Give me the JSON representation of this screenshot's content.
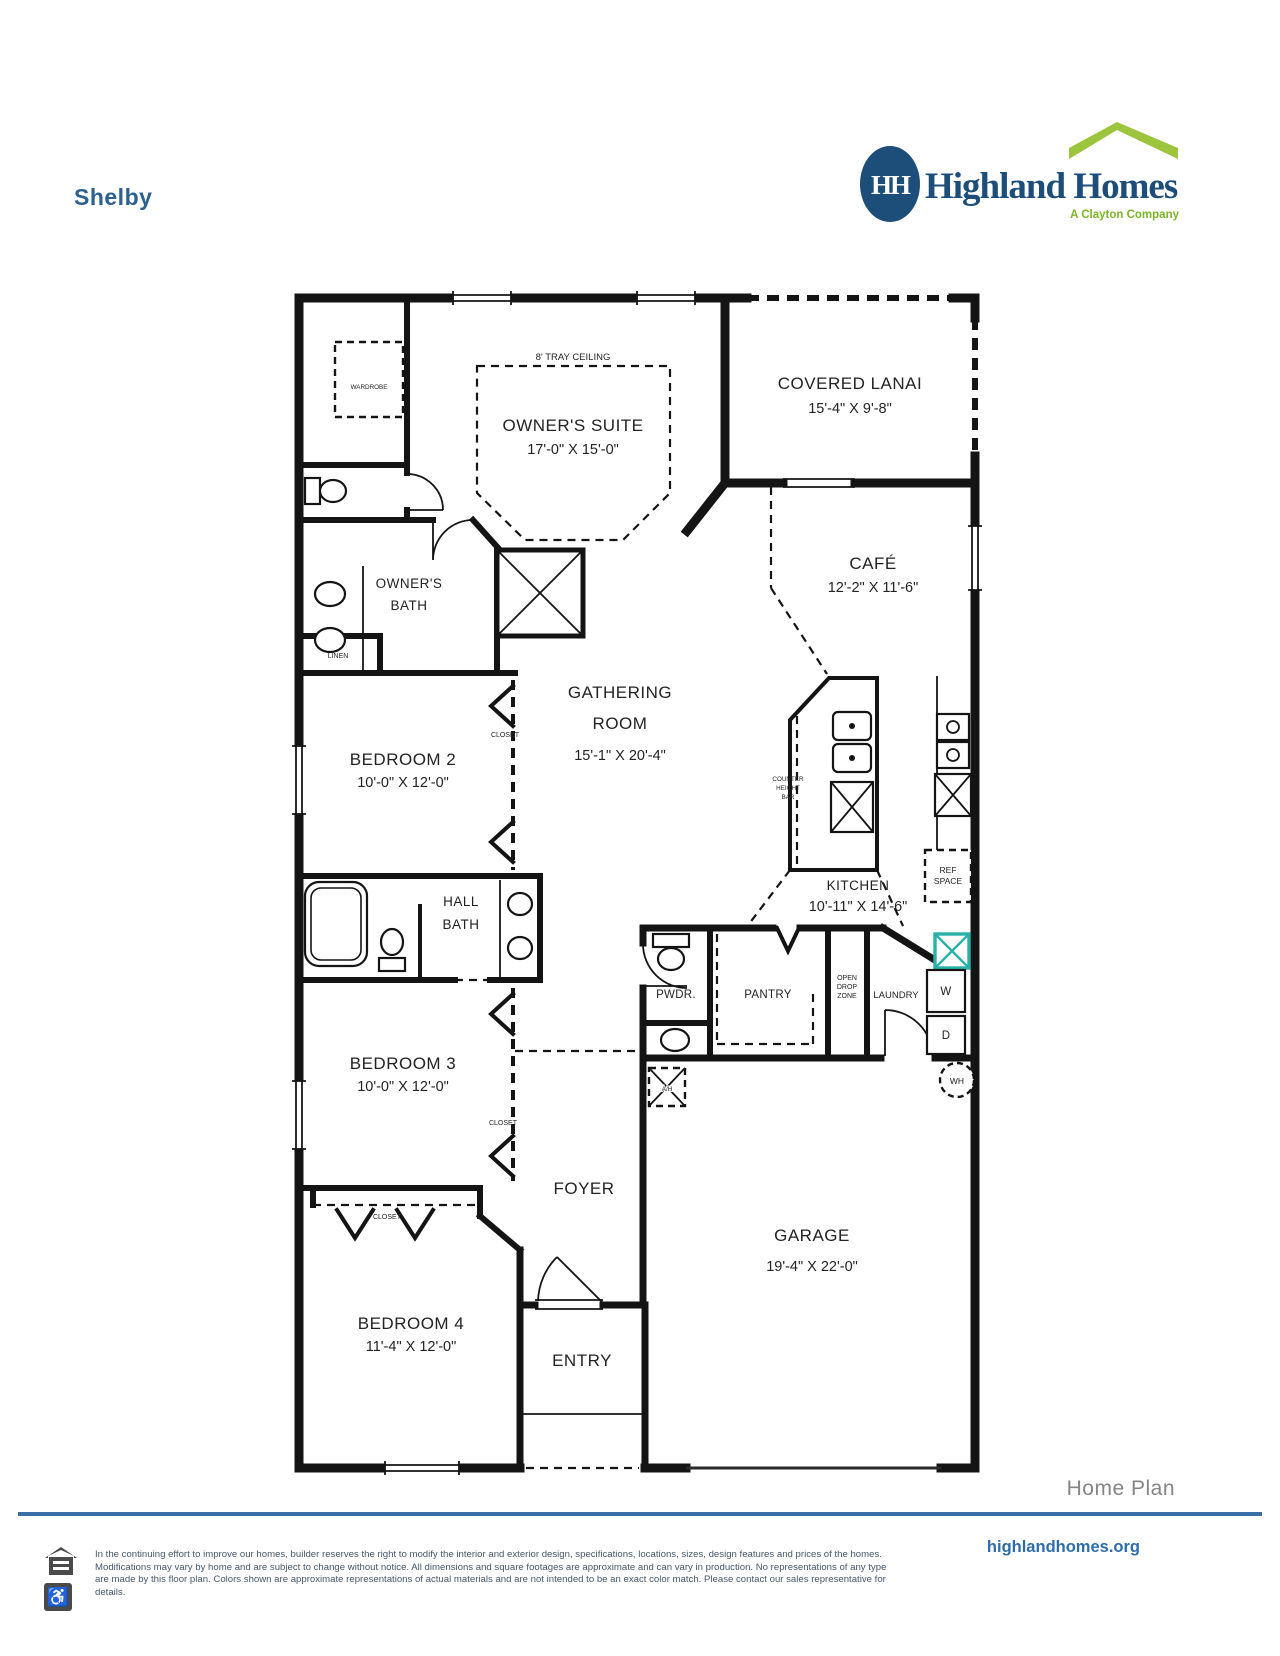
{
  "page": {
    "title": "Shelby"
  },
  "logo": {
    "monogram": "HH",
    "brand": "Highland Homes",
    "tagline": "A Clayton Company",
    "brand_color": "#1d4e79",
    "accent_green": "#9cc43c"
  },
  "plan": {
    "rooms": [
      {
        "name": "OWNER'S SUITE",
        "dims": "17'-0\" X 15'-0\""
      },
      {
        "name": "COVERED LANAI",
        "dims": "15'-4\" X 9'-8\""
      },
      {
        "name": "CAFÉ",
        "dims": "12'-2\" X 11'-6\""
      },
      {
        "name_line1": "GATHERING",
        "name_line2": "ROOM",
        "dims": "15'-1\" X 20'-4\""
      },
      {
        "name": "BEDROOM 2",
        "dims": "10'-0\" X 12'-0\""
      },
      {
        "name": "KITCHEN",
        "dims": "10'-11\" X 14'-6\""
      },
      {
        "name": "BEDROOM 3",
        "dims": "10'-0\" X 12'-0\""
      },
      {
        "name": "GARAGE",
        "dims": "19'-4\" X 22'-0\""
      },
      {
        "name": "BEDROOM 4",
        "dims": "11'-4\" X 12'-0\""
      }
    ],
    "labels": {
      "tray_ceiling": "8' TRAY CEILING",
      "wardrobe": "WARDROBE",
      "owners_bath_1": "OWNER'S",
      "owners_bath_2": "BATH",
      "linen": "LINEN",
      "closet": "CLOSET",
      "hall_bath_1": "HALL",
      "hall_bath_2": "BATH",
      "counter_1": "COUNTER",
      "counter_2": "HEIGHT",
      "counter_3": "BAR",
      "ref_1": "REF",
      "ref_2": "SPACE",
      "pwdr": "PWDR.",
      "pantry": "PANTRY",
      "drop_1": "OPEN",
      "drop_2": "DROP",
      "drop_3": "ZONE",
      "laundry": "LAUNDRY",
      "washer": "W",
      "dryer": "D",
      "water_heater": "WH",
      "air_handler": "A/H",
      "foyer": "FOYER",
      "entry": "ENTRY"
    },
    "highlight_color": "#29b1a9"
  },
  "footer": {
    "heading": "Home Plan",
    "website": "highlandhomes.org",
    "disclaimer_lines": [
      "In the continuing effort to improve our homes, builder reserves the right to modify the interior and exterior design, specifications, locations, sizes, design features and prices of the homes.",
      "Modifications may vary by home and are subject to change without notice. All dimensions and square footages are approximate and can vary in production. No representations of any type",
      "are made by this floor plan. Colors shown are approximate representations of actual materials and are not intended to be an exact color match. Please contact our sales representative for",
      "details."
    ]
  }
}
